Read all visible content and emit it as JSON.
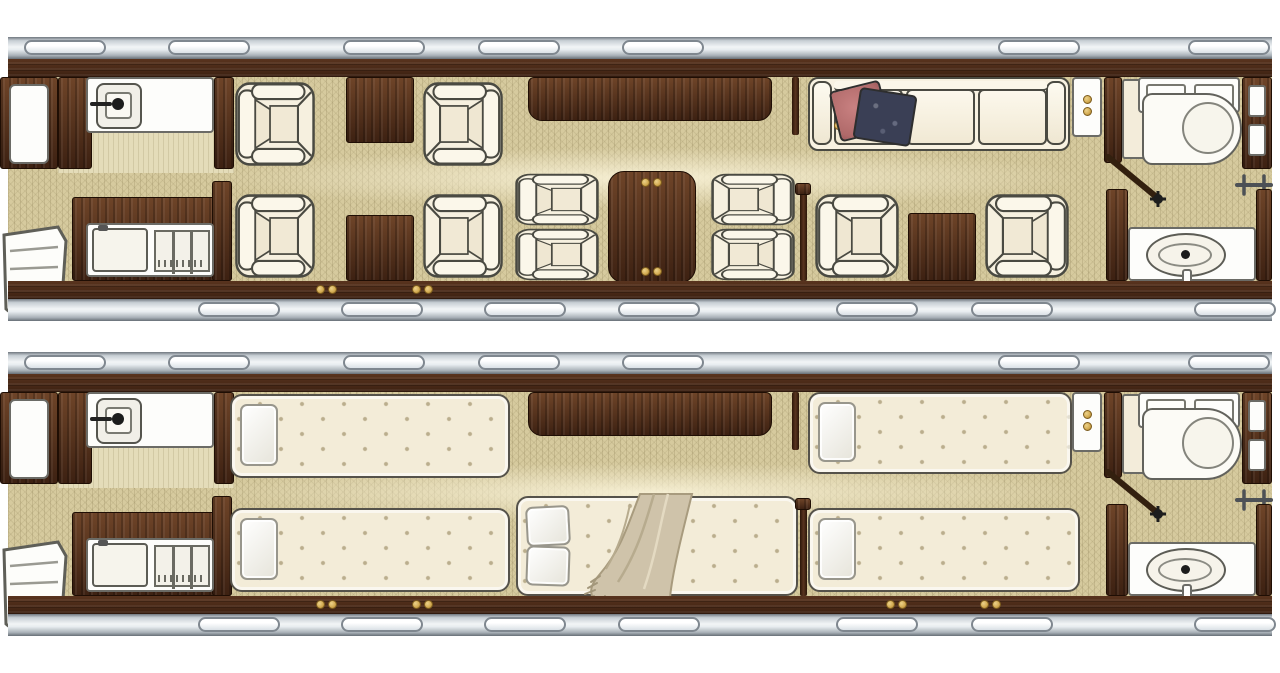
{
  "document": {
    "views": [
      {
        "id": "day",
        "semantic_name": "cabin-floorplan-day-configuration"
      },
      {
        "id": "night",
        "semantic_name": "cabin-floorplan-night-configuration"
      }
    ],
    "icons": [
      "cabin-window",
      "lavatory-sink-icon",
      "vanity-sink-icon",
      "toilet-icon",
      "door-swing-icon",
      "hanging-rod-icon",
      "cupholder-brass-icon",
      "airstair-entry-icon"
    ]
  },
  "colors": {
    "canvas_bg": "#ffffff",
    "window_fill": "#ffffff",
    "wood_dark": "#3d2112",
    "wood_mid": "#59341e",
    "wood_light": "#6e4428",
    "carpet": "#d6ca9e",
    "lav_floor": "#e4dcb9",
    "mattress": "#f3ecd8",
    "fixture_white": "#fdfdfb",
    "fixture_line": "#6b6b66",
    "brass": "#d2a94f",
    "brass_edge": "#7c5c1e",
    "pillow_rose": "#b06a6a",
    "pillow_navy": "#3a3f55",
    "blanket": "#cfc3aa",
    "blanket_fold": "#a89b7e",
    "upholstery_cream": "#f5efde",
    "outline_dark": "#4a4a42"
  }
}
